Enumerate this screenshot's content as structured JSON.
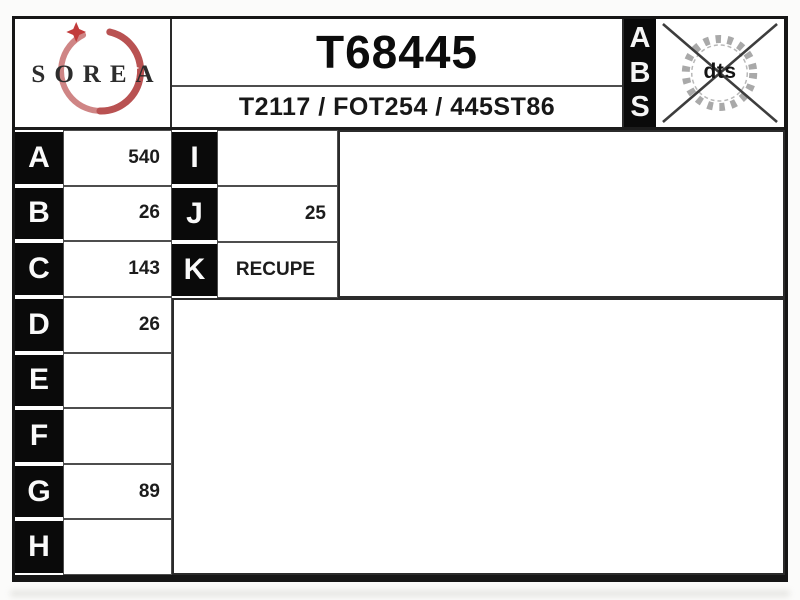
{
  "header": {
    "brand": "SOREA",
    "part_number": "T68445",
    "cross_references": "T2117 / FOT254 / 445ST86",
    "abs_letters": [
      "A",
      "B",
      "S"
    ],
    "gear_label": "dts"
  },
  "left_table": {
    "rows": [
      {
        "label": "A",
        "value": "540"
      },
      {
        "label": "B",
        "value": "26"
      },
      {
        "label": "C",
        "value": "143"
      },
      {
        "label": "D",
        "value": "26"
      },
      {
        "label": "E",
        "value": ""
      },
      {
        "label": "F",
        "value": ""
      },
      {
        "label": "G",
        "value": "89"
      },
      {
        "label": "H",
        "value": ""
      }
    ]
  },
  "ijk_table": {
    "rows": [
      {
        "label": "I",
        "value": ""
      },
      {
        "label": "J",
        "value": "25"
      },
      {
        "label": "K",
        "value": "RECUPE"
      }
    ]
  },
  "colors": {
    "accent_red": "#c05656",
    "cell_black": "#0a0a0a",
    "gear_gray": "#a9a9a9"
  }
}
